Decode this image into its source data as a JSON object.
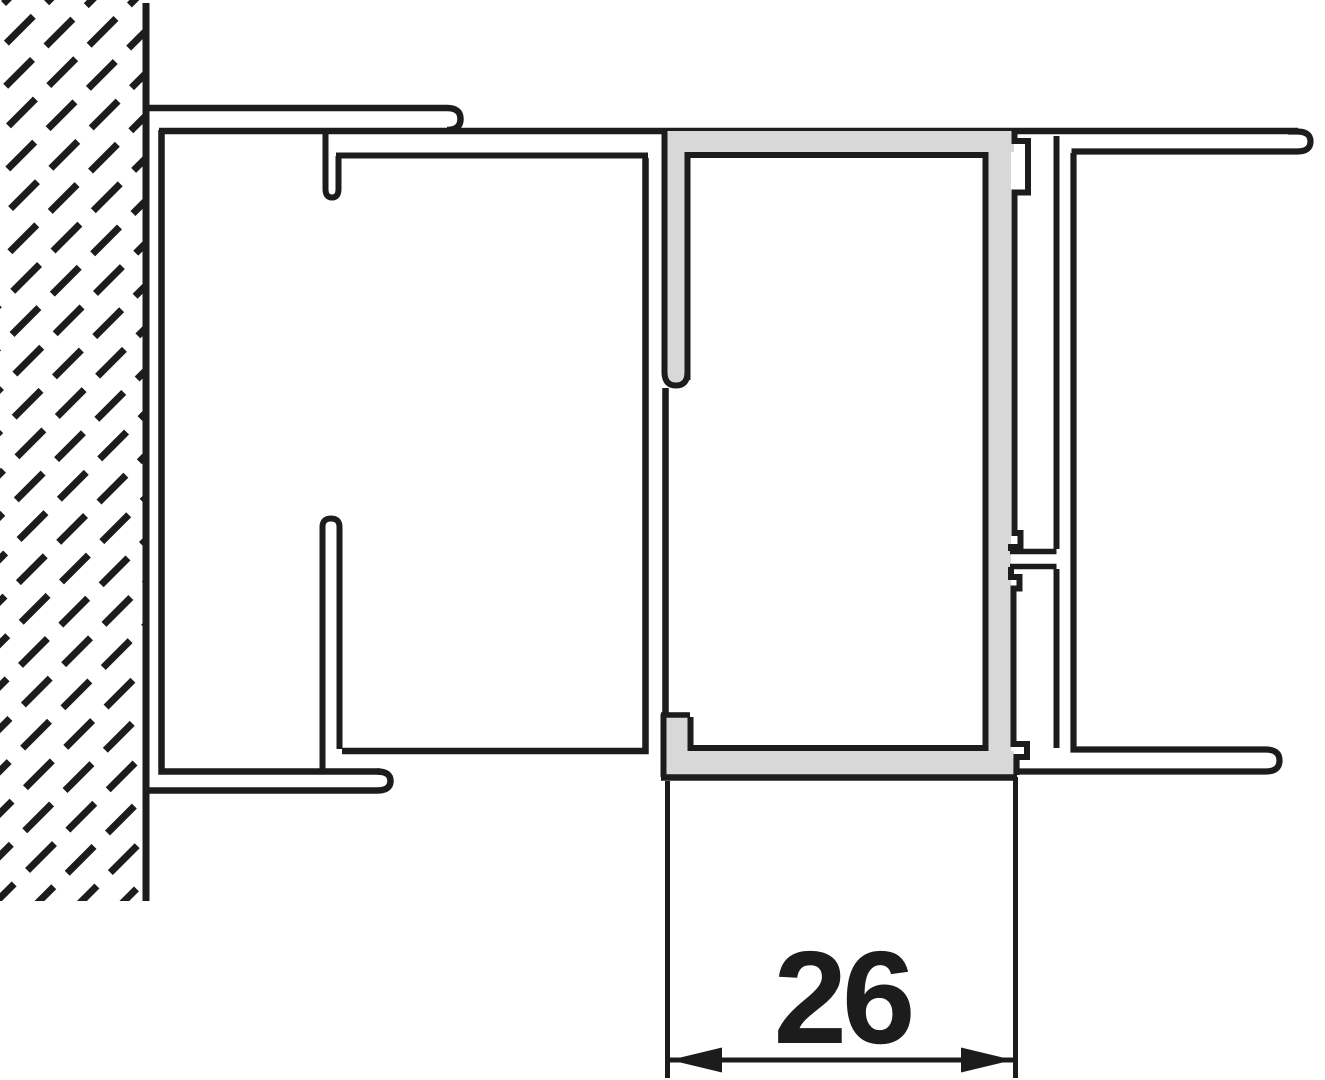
{
  "dimension": {
    "label": "26"
  },
  "colors": {
    "ink": "#1c1c1c",
    "profile-fill": "#d8d8d8",
    "background": "#ffffff"
  }
}
